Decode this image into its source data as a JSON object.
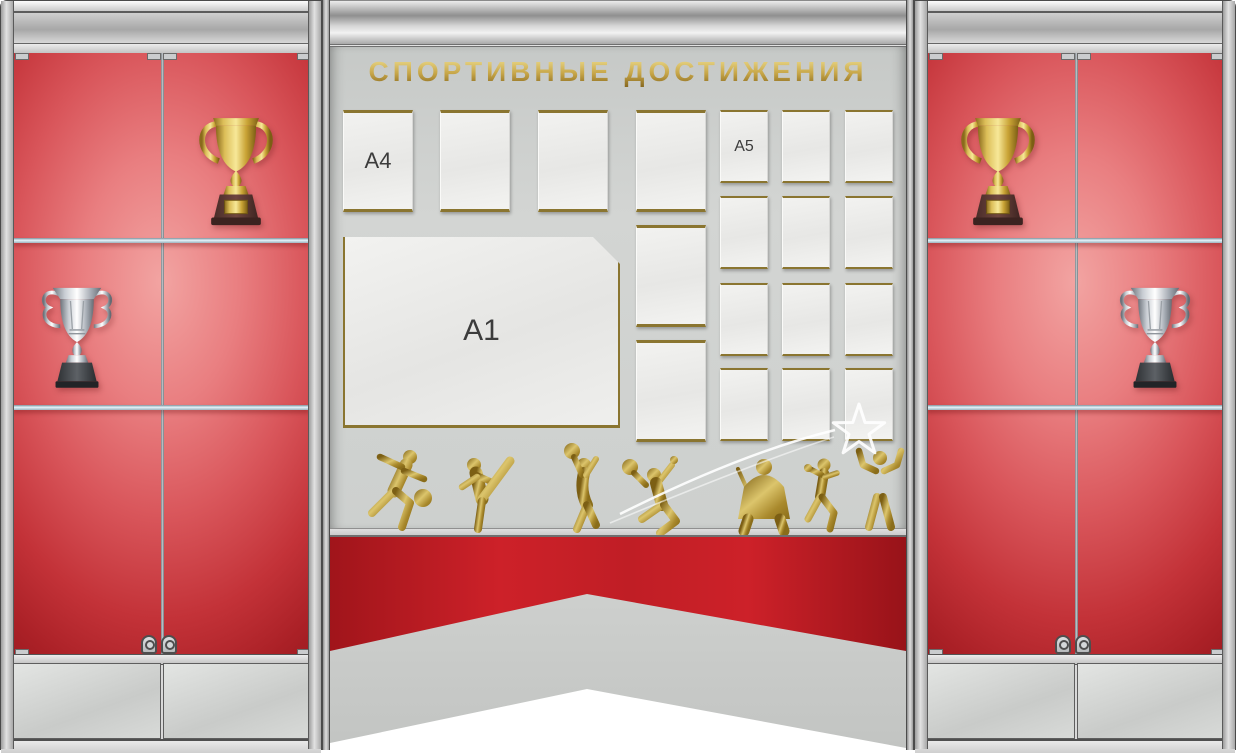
{
  "board_title": {
    "text": "СПОРТИВНЫЕ ДОСТИЖЕНИЯ"
  },
  "pocket_labels": {
    "a4": "A4",
    "a1": "A1",
    "a5": "A5"
  },
  "pocket_counts": {
    "a4_portrait": 6,
    "a1_landscape": 1,
    "a5_portrait": 12
  },
  "sport_icons": [
    "soccer-player",
    "karate-kick",
    "volleyball-serve",
    "tennis-jump",
    "hockey-goalie",
    "boxer",
    "champion-flex"
  ],
  "decor_icons": [
    "shooting-star",
    "swoosh-trails"
  ],
  "cabinets": {
    "left": {
      "trophies": [
        "gold-cup",
        "silver-cup"
      ],
      "shelves": 2,
      "doors": 2,
      "locks": 2
    },
    "right": {
      "trophies": [
        "gold-cup",
        "silver-cup"
      ],
      "shelves": 2,
      "doors": 2,
      "locks": 2
    }
  },
  "colors": {
    "display_red": "#c8262d",
    "ribbon_red": "#c0202a",
    "gold_trim": "#8a7530",
    "gold_text": "#c6a547",
    "panel_grey": "#ced1cf",
    "metal_silver": "#c6c6c6"
  }
}
